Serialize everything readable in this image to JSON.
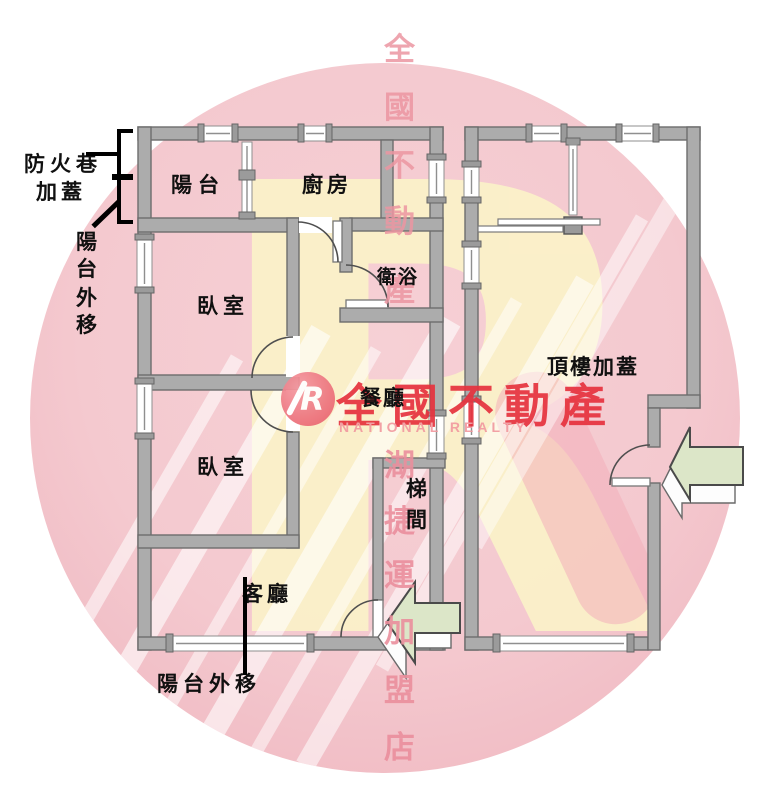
{
  "watermark": {
    "big_letter": "R",
    "vertical_top": "全國不動產",
    "vertical_bottom": "湖捷運加盟店",
    "brand": {
      "monogram": "R",
      "name_cjk": "全國不動產",
      "name_en": "NATIONAL REALTY",
      "red": "#e6323e",
      "pink": "#f29aa0"
    },
    "circle_color": "#f4c9cf",
    "big_letter_color": "#fbf1c9"
  },
  "plan": {
    "rooms": {
      "balcony": "陽台",
      "kitchen": "廚房",
      "bathroom": "衛浴",
      "bedroom_upper": "臥室",
      "bedroom_lower": "臥室",
      "dining": "餐廳",
      "living": "客廳",
      "stairwell": "梯間",
      "rooftop": "頂樓加蓋"
    },
    "annotations": {
      "fire_lane_l1": "防火巷",
      "fire_lane_l2": "加蓋",
      "balcony_out_left": "陽台外移",
      "balcony_out_bottom": "陽台外移"
    },
    "wall_color": "#acacac",
    "arrow_color": "#dce6c8"
  }
}
